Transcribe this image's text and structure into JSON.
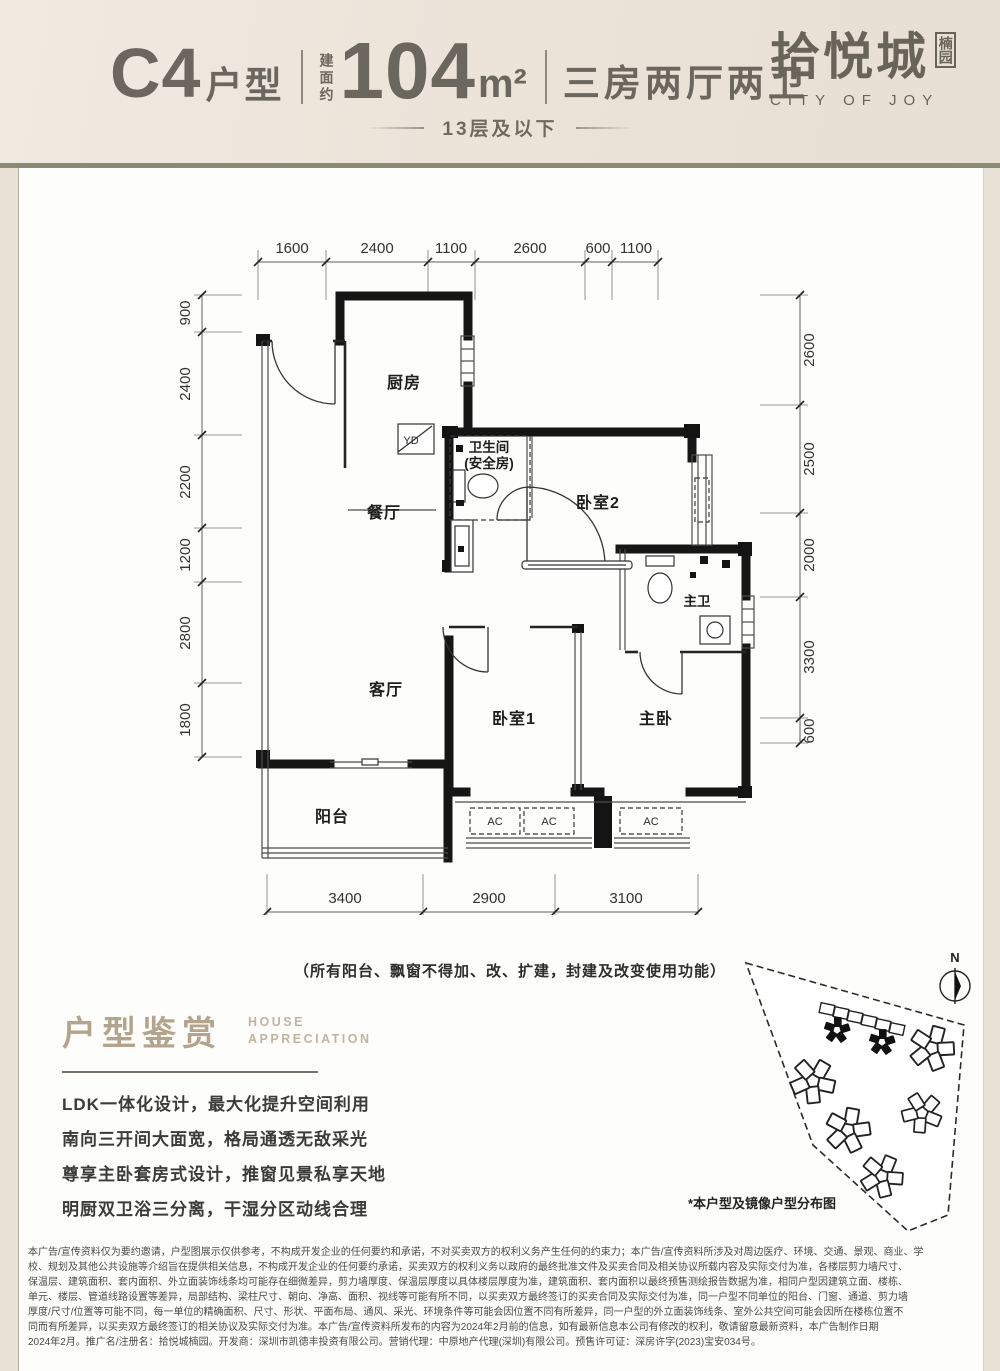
{
  "header": {
    "unit": "C4",
    "unit_suffix": "户型",
    "area_prefix": "建面约",
    "area_value": "104",
    "area_unit": "m²",
    "layout": "三房两厅两卫",
    "floor_note": "13层及以下",
    "brand": "拾悦城",
    "brand_seal": "楠园",
    "brand_en": "CITY OF JOY"
  },
  "plan": {
    "dims_top": [
      "1600",
      "2400",
      "1100",
      "2600",
      "600",
      "1100"
    ],
    "dims_left": [
      "900",
      "2400",
      "2200",
      "1200",
      "2800",
      "1800"
    ],
    "dims_right": [
      "2600",
      "2500",
      "2000",
      "3300",
      "600"
    ],
    "dims_bottom": [
      "3400",
      "2900",
      "3100"
    ],
    "rooms": {
      "kitchen": "厨房",
      "dining": "餐厅",
      "living": "客厅",
      "balcony": "阳台",
      "bath_l1": "卫生间",
      "bath_l2": "(安全房)",
      "bedroom2": "卧室2",
      "master_bath": "主卫",
      "bedroom1": "卧室1",
      "master": "主卧",
      "yd": "YD",
      "ac": "AC"
    },
    "note": "（所有阳台、飘窗不得加、改、扩建，封建及改变使用功能）"
  },
  "appreciation": {
    "title": "户型鉴赏",
    "subtitle_line1": "HOUSE",
    "subtitle_line2": "APPRECIATION",
    "points": [
      "LDK一体化设计，最大化提升空间利用",
      "南向三开间大面宽，格局通透无敌采光",
      "尊享主卧套房式设计，推窗见景私享天地",
      "明厨双卫浴三分离，干湿分区动线合理"
    ]
  },
  "siteplan": {
    "caption": "*本户型及镜像户型分布图",
    "compass": "N"
  },
  "legal": {
    "lines": [
      "本广告/宣传资料仅为要约邀请，户型图展示仅供参考，不构成开发企业的任何要约和承诺，不对买卖双方的权利义务产生任何的约束力；本广告/宣传资料所涉及对周边医疗、环境、交通、景观、商业、学",
      "校、规划及其他公共设施等介绍旨在提供相关信息，不构成开发企业的任何要约承诺，买卖双方的权利义务以政府的最终批准文件及买卖合同及相关协议所载内容及实际交付为准，各楼层剪力墙尺寸、",
      "保温层、建筑面积、套内面积、外立面装饰线条均可能存在细微差异，剪力墙厚度、保温层厚度以具体楼层厚度为准，建筑面积、套内面积以最终预售测绘报告数据为准，相同户型因建筑立面、楼栋、",
      "单元、楼层、管道线路设置等差异，局部结构、梁柱尺寸、朝向、净高、面积、视线等可能有所不同，以买卖双方最终签订的买卖合同及实际交付为准，同一户型不同单位的阳台、门窗、通道、剪力墙",
      "厚度/尺寸/位置等可能不同，每一单位的精确面积、尺寸、形状、平面布局、通风、采光、环境条件等可能会因位置不同有所差异，同一户型的外立面装饰线条、室外公共空间可能会因所在楼栋位置不",
      "同而有所差异，以买卖双方最终签订的相关协议及实际交付为准。本广告/宣传资料所发布的内容为2024年2月前的信息，如有最新信息本公司有修改的权利，敬请留意最新资料，本广告制作日期",
      "2024年2月。推广名/注册名：拾悦城楠园。开发商：深圳市凯德丰投资有限公司。营销代理：中原地产代理(深圳)有限公司。预售许可证：深房许字(2023)宝安034号。"
    ]
  }
}
